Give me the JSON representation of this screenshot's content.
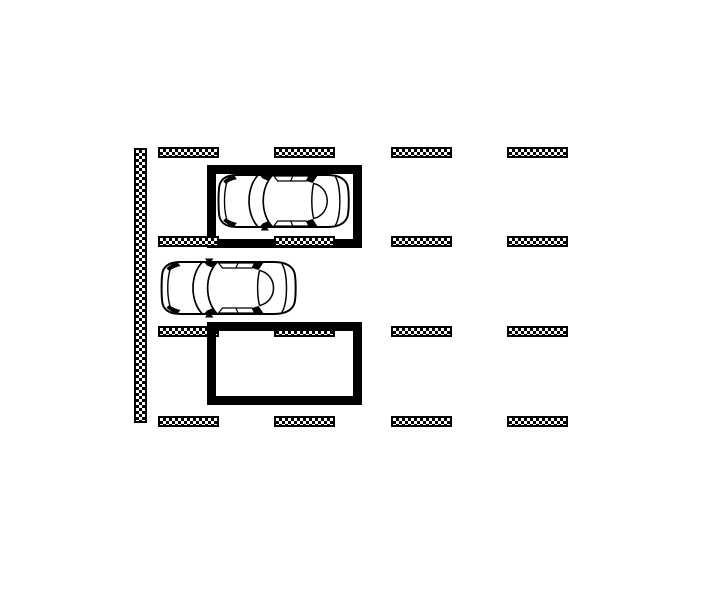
{
  "diagram": {
    "name": "parking-lot-top-view-plan",
    "background_color": "#ffffff",
    "line_color": "#000000",
    "wall": {
      "x": 134,
      "y": 148,
      "width": 13,
      "height": 275
    },
    "curbs": {
      "rows_y": [
        147,
        236,
        326,
        416
      ],
      "cols_x": [
        158,
        274,
        391,
        507
      ],
      "width": 61,
      "height": 11,
      "count": 16
    },
    "stalls": {
      "occupied": {
        "x": 207,
        "y": 165,
        "width": 155,
        "height": 83,
        "border": 9
      },
      "empty": {
        "x": 207,
        "y": 322,
        "width": 155,
        "height": 83,
        "border": 9
      }
    },
    "cars": {
      "parked": {
        "x": 216,
        "y": 171,
        "width": 136,
        "height": 60,
        "facing": "left"
      },
      "maneuvering": {
        "x": 159,
        "y": 258,
        "width": 140,
        "height": 60,
        "facing": "left"
      }
    }
  }
}
